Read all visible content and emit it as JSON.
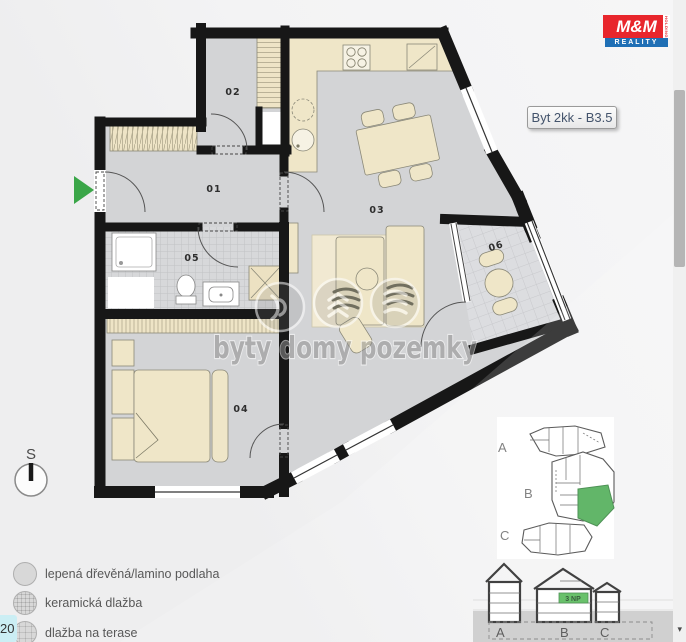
{
  "logo": {
    "top": "M&M",
    "bottom": "REALITY",
    "side": "HOLDING",
    "red": "#e8262c",
    "blue": "#1f6fb5"
  },
  "unit_tag": {
    "label": "Byt 2kk - B3.5"
  },
  "plan": {
    "room_labels": [
      "01",
      "02",
      "03",
      "04",
      "05",
      "06"
    ],
    "compass_letter": "S",
    "entrance_color": "#3aa648"
  },
  "watermark": {
    "text": "byty domy pozemky",
    "icons": [
      "sound-waves-icon",
      "chevrons-up-icon",
      "tilted-stripes-icon"
    ]
  },
  "legend": {
    "items": [
      {
        "swatch": "plain-floor",
        "label": "lepená dřevěná/lamino podlaha"
      },
      {
        "swatch": "ceramic-tile",
        "label": "keramická dlažba"
      },
      {
        "swatch": "terrace-tile",
        "label": "dlažba na terase"
      }
    ]
  },
  "corner_badge": {
    "label": "20"
  },
  "minimap": {
    "section_labels": [
      "A",
      "B",
      "C"
    ],
    "highlight_color": "#45a94d"
  },
  "elevation": {
    "axis_labels": [
      "A",
      "B",
      "C"
    ],
    "floor_tag": "3 NP",
    "highlight_color": "#4db54f"
  },
  "scrollbar": {
    "down_arrow": "▾"
  }
}
